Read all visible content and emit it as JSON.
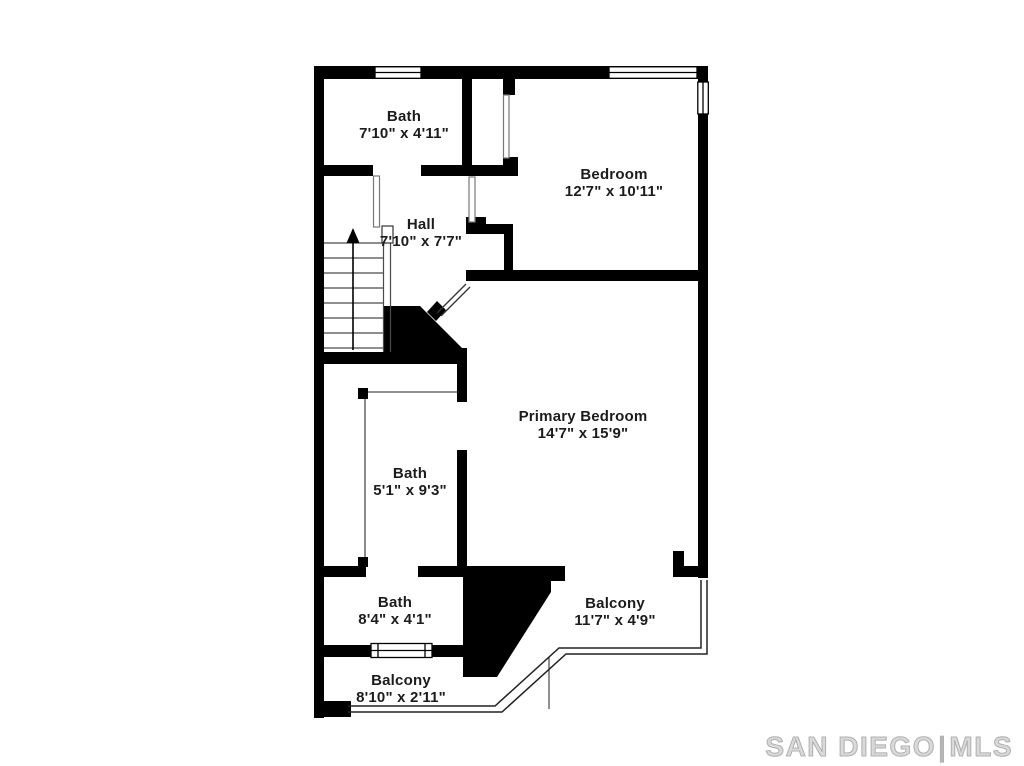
{
  "floorplan": {
    "rooms": {
      "bath_upper": {
        "name": "Bath",
        "dims": "7'10\" x 4'11\""
      },
      "bedroom": {
        "name": "Bedroom",
        "dims": "12'7\" x 10'11\""
      },
      "hall": {
        "name": "Hall",
        "dims": "7'10\" x 7'7\""
      },
      "primary_bedroom": {
        "name": "Primary Bedroom",
        "dims": "14'7\" x 15'9\""
      },
      "bath_middle": {
        "name": "Bath",
        "dims": "5'1\" x 9'3\""
      },
      "bath_lower": {
        "name": "Bath",
        "dims": "8'4\" x 4'1\""
      },
      "balcony_right": {
        "name": "Balcony",
        "dims": "11'7\" x 4'9\""
      },
      "balcony_left": {
        "name": "Balcony",
        "dims": "8'10\" x 2'11\""
      }
    },
    "stairs": {
      "direction": "up"
    },
    "colors": {
      "wall": "#000000",
      "background": "#ffffff",
      "label_text": "#1c1c1c",
      "thin_line": "#555555",
      "watermark_gray": "#b5b5b5"
    }
  },
  "watermark": {
    "brand": "SAN DIEGO",
    "separator": "|",
    "suffix": "MLS"
  }
}
